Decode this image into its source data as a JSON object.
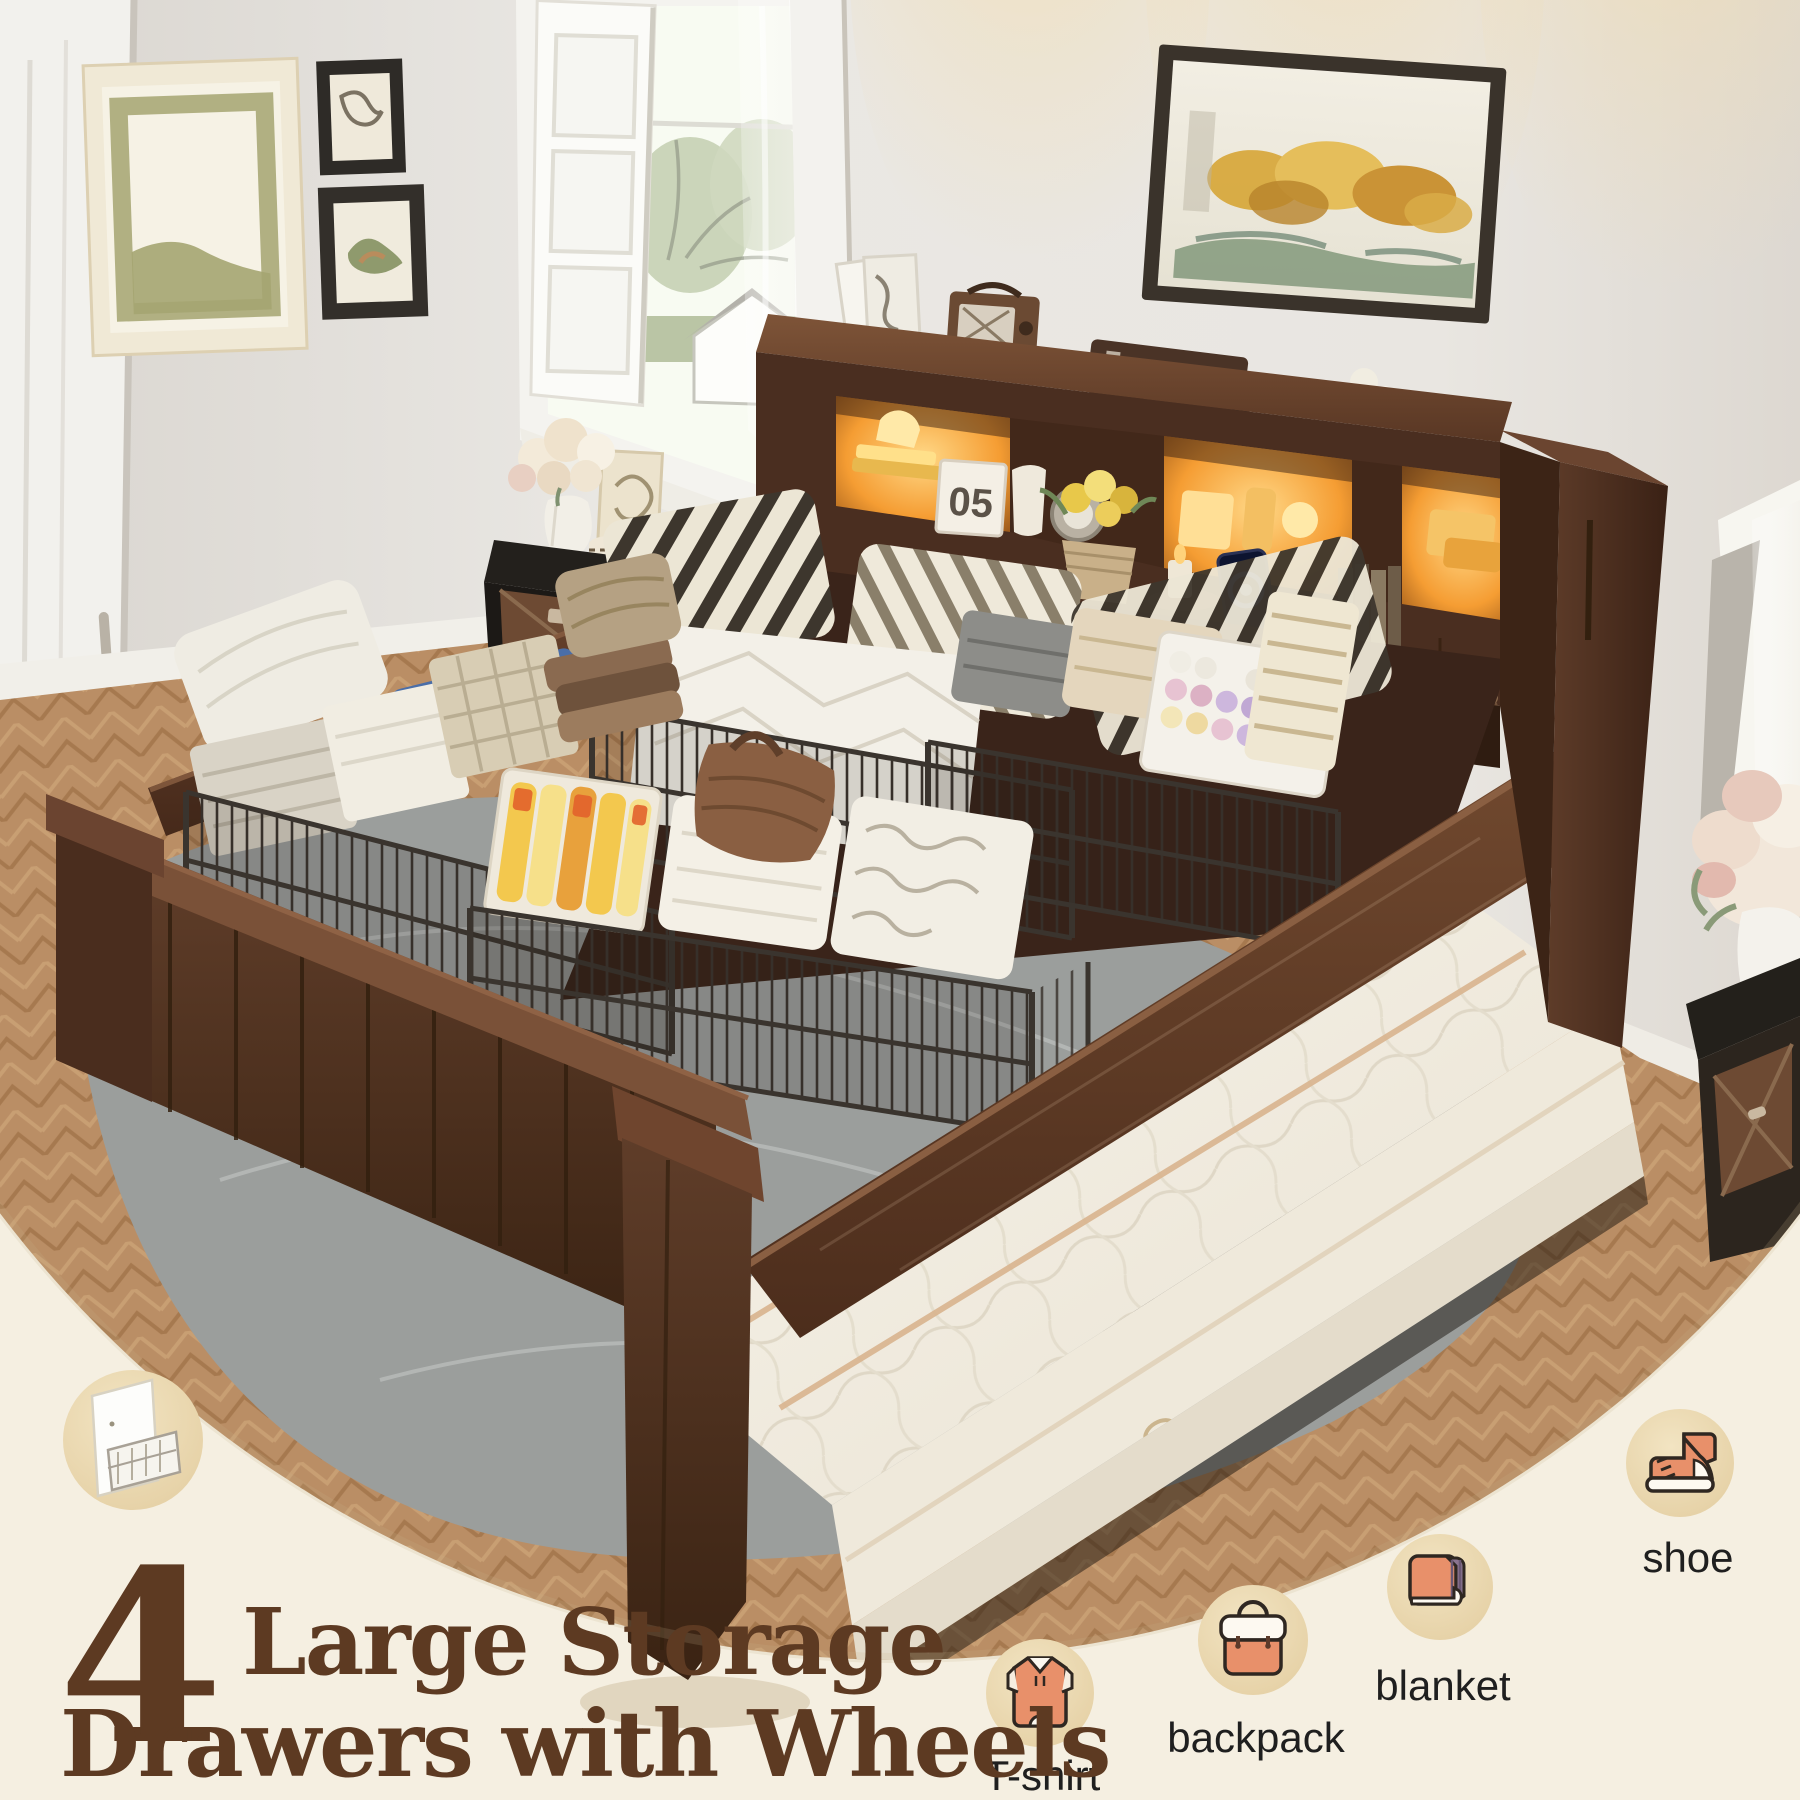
{
  "image_type": "e-commerce product marketing photo",
  "scene": "bedroom with wood storage bed, LED bookcase headboard and four wire under-bed drawers filled with folded clothes",
  "headline": {
    "number": "4",
    "line1": "Large Storage",
    "line2": "Drawers with Wheels",
    "text_color": "#5d3a22"
  },
  "feature_badges": [
    {
      "label": "T-shirt",
      "icon": "tshirt-icon"
    },
    {
      "label": "backpack",
      "icon": "backpack-icon"
    },
    {
      "label": "blanket",
      "icon": "blanket-icon"
    },
    {
      "label": "shoe",
      "icon": "shoe-icon"
    }
  ],
  "inset_badge": {
    "icon": "storage-drawer-sketch-icon"
  },
  "photo_decor": {
    "calendar_text": "05"
  },
  "colors": {
    "overlay_cream": "#f5efe1",
    "badge_circle": "#ecd9b4",
    "icon_orange": "#e8906a",
    "icon_outline": "#2f2721",
    "wood_dark": "#4a2e20",
    "wood_mid": "#6b4530",
    "led_glow": "#ffbb4d",
    "wall": "#e8e5e0",
    "rug_gray": "#9b9e9c",
    "floor_tan": "#c0936a",
    "mattress_white": "#f4efe5"
  }
}
